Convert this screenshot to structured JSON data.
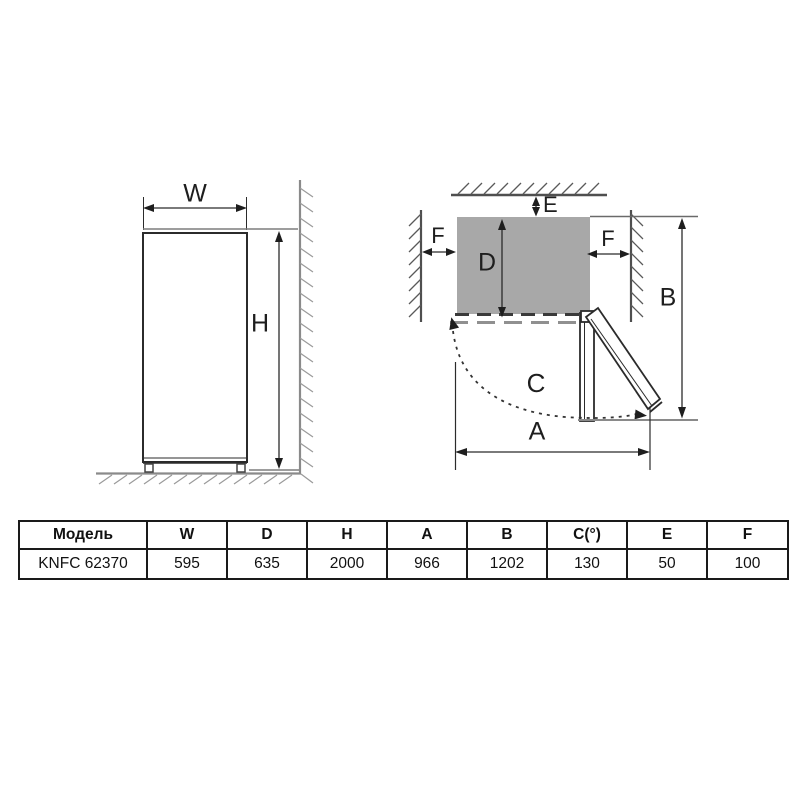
{
  "diagram": {
    "front_view": {
      "width_label": "W",
      "height_label": "H"
    },
    "top_view": {
      "gap_top_label": "E",
      "gap_left_label": "F",
      "gap_right_label": "F",
      "depth_label": "D",
      "total_depth_label": "B",
      "door_arc_label": "C",
      "total_width_label": "A"
    },
    "colors": {
      "fridge_fill": "#a8a8a8",
      "object_line": "#2b2b2b",
      "wall_light": "#8a8a8a",
      "wall_dark": "#4f4f4f"
    }
  },
  "table": {
    "headers": [
      "Модель",
      "W",
      "D",
      "H",
      "A",
      "B",
      "C(°)",
      "E",
      "F"
    ],
    "rows": [
      [
        "KNFC 62370",
        "595",
        "635",
        "2000",
        "966",
        "1202",
        "130",
        "50",
        "100"
      ]
    ]
  }
}
